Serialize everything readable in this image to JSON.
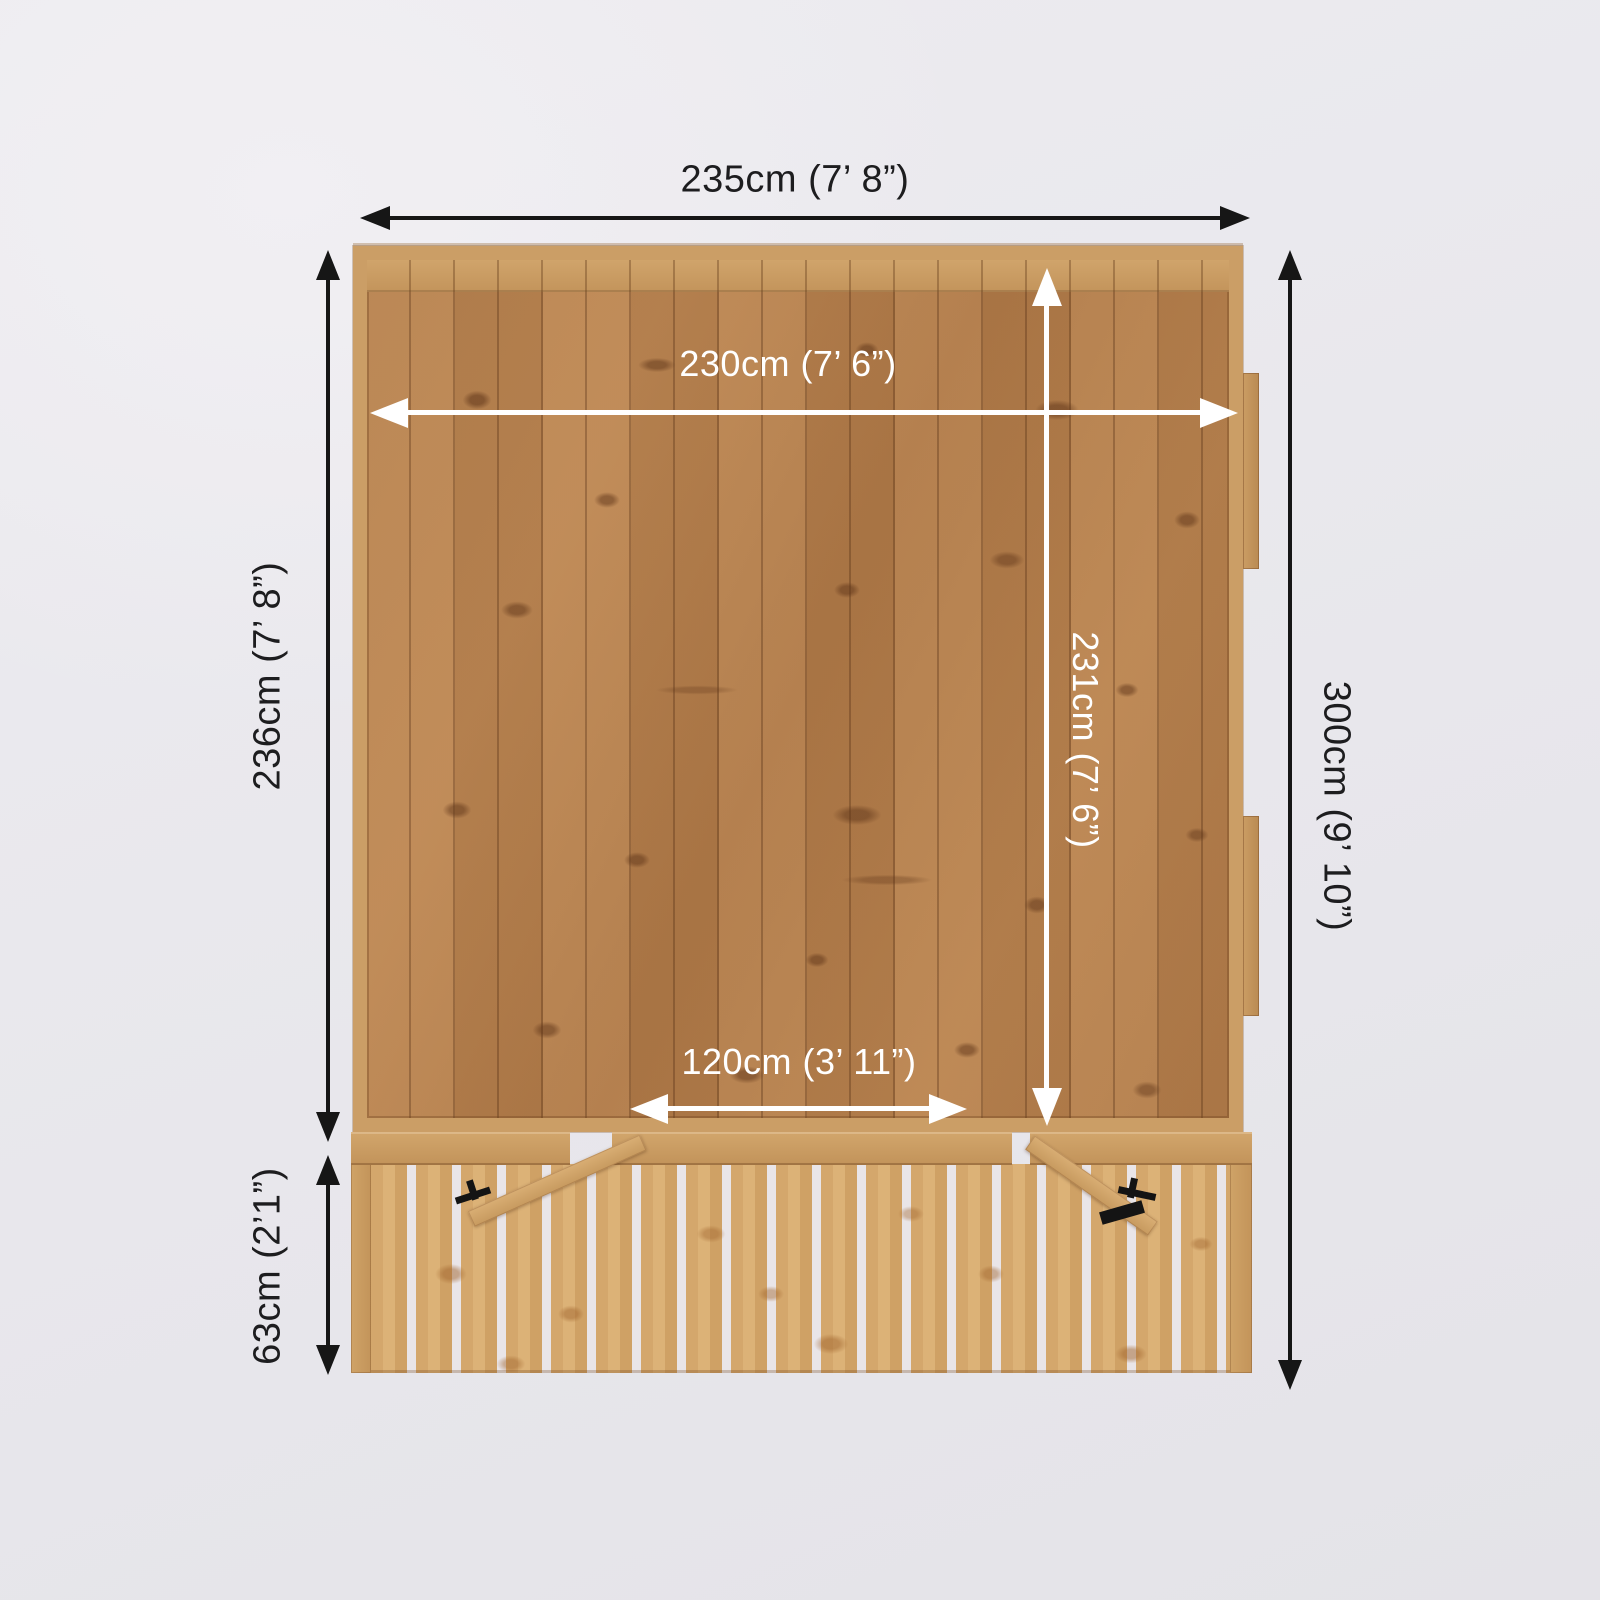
{
  "diagram": {
    "description": "Top-down dimension diagram of a wooden summerhouse with front veranda decking and open gates",
    "dimensions": {
      "external_width": {
        "value_cm": 235,
        "imperial": "7’ 8”",
        "label": "235cm (7’ 8”)"
      },
      "internal_width": {
        "value_cm": 230,
        "imperial": "7’ 6”",
        "label": "230cm (7’ 6”)"
      },
      "main_depth": {
        "value_cm": 236,
        "imperial": "7’ 8”",
        "label": "236cm (7’ 8”)"
      },
      "total_depth": {
        "value_cm": 300,
        "imperial": "9’ 10”",
        "label": "300cm (9’ 10”)"
      },
      "internal_depth": {
        "value_cm": 231,
        "imperial": "7’ 6”",
        "label": "231cm (7’ 6”)"
      },
      "door_width": {
        "value_cm": 120,
        "imperial": "3’ 11”",
        "label": "120cm (3’ 11”)"
      },
      "veranda_depth": {
        "value_cm": 63,
        "imperial": "2’1”",
        "label": "63cm (2’1”)"
      }
    },
    "colors": {
      "background": "#e9e8ed",
      "arrow_dark": "#161616",
      "arrow_light": "#ffffff",
      "wood_frame": "#cb9e66",
      "wood_interior": "#b5804f",
      "wood_deck": "#d4a76c"
    }
  }
}
